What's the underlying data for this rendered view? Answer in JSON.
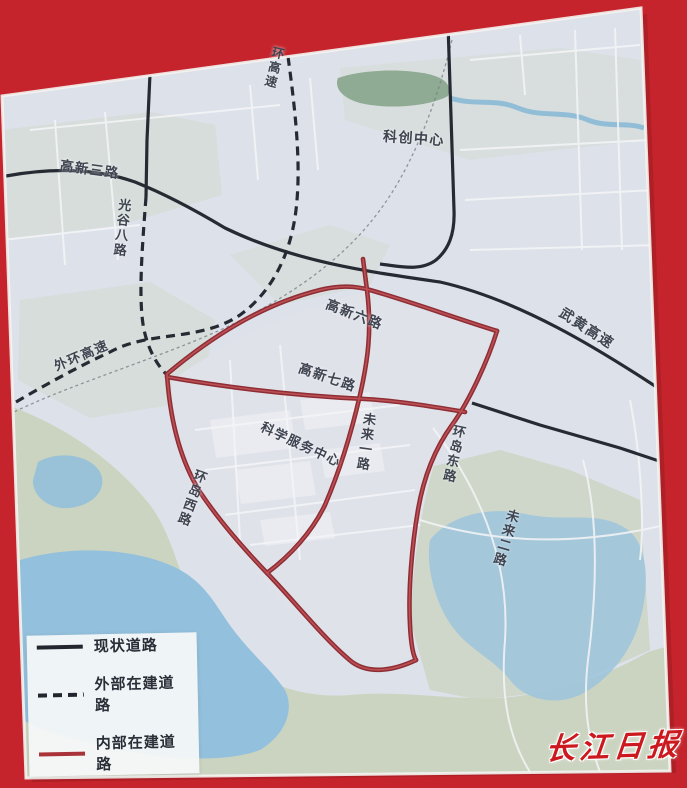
{
  "colors": {
    "background_red": "#c5242c",
    "map_base": "#dde1e9",
    "water": "#93c0dc",
    "park": "#8fab94",
    "south_land": "#cbd4c0",
    "road_existing": "#262a33",
    "road_external_planned": "#262a33",
    "road_internal_planned": "#a93339",
    "road_minor": "#f4f5f7",
    "watermark_red": "#cb191f"
  },
  "map": {
    "labels": {
      "gaoxin3": "高新三路",
      "guanggu8": "光谷八路",
      "huan_gaosu": "环高速",
      "kechuang_zhongxin": "科创中心",
      "waihuan_gaosu": "外环高速",
      "wuhuang_gaosu": "武黄高速",
      "gaoxin6": "高新六路",
      "gaoxin7": "高新七路",
      "kexue_fuwu_zhongxin": "科学服务中心",
      "weilai1": "未来一路",
      "huandao_dong": "环岛东路",
      "weilai2": "未来二路",
      "huandao_xi": "环岛西路"
    }
  },
  "legend": {
    "items": [
      {
        "label": "现状道路",
        "style": "solid-black"
      },
      {
        "label": "外部在建道路",
        "style": "dashed-black"
      },
      {
        "label": "内部在建道路",
        "style": "solid-red"
      }
    ]
  },
  "watermark": {
    "text": "长江日报"
  }
}
